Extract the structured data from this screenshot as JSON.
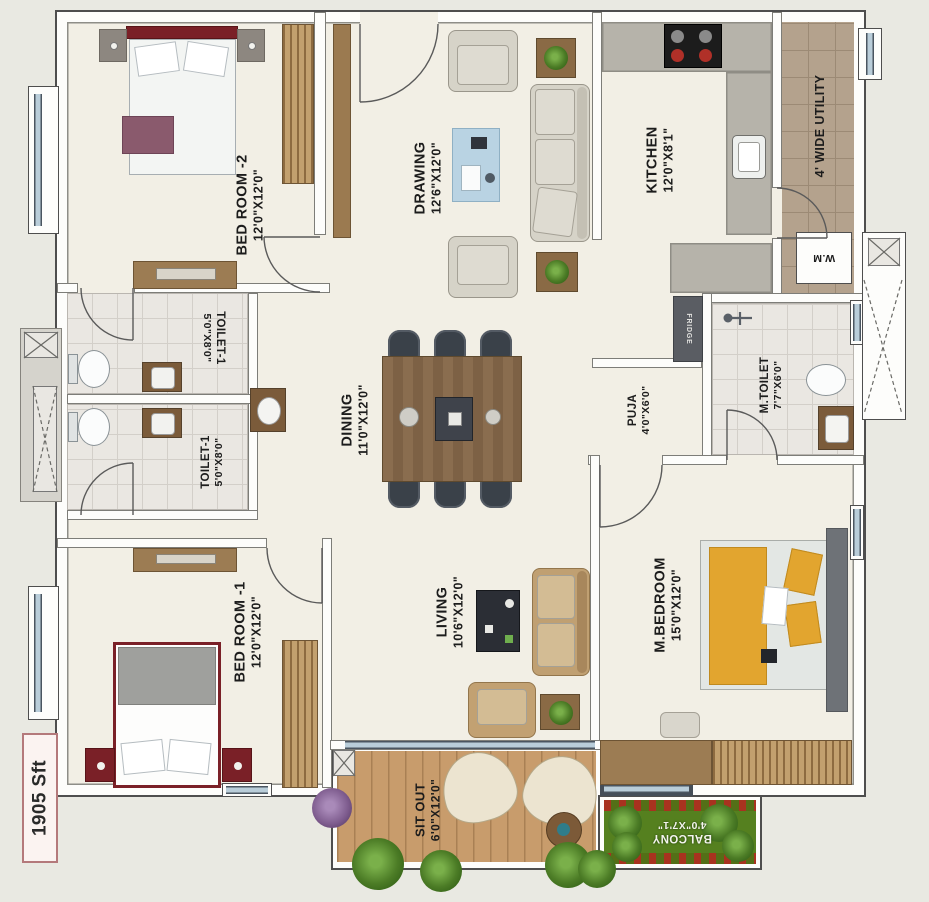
{
  "area_label": "1905 Sft",
  "rooms": {
    "bedroom2": {
      "name": "BED ROOM -2",
      "dims": "12'0\"X12'0\""
    },
    "drawing": {
      "name": "DRAWING",
      "dims": "12'6\"X12'0\""
    },
    "kitchen": {
      "name": "KITCHEN",
      "dims": "12'0\"X8'1\""
    },
    "utility": {
      "name": "4' WIDE UTILITY"
    },
    "toilet_upper": {
      "name": "TOILET-1",
      "dims": "5'0\"X8'0\""
    },
    "toilet_lower": {
      "name": "TOILET-1",
      "dims": "5'0\"X8'0\""
    },
    "dining": {
      "name": "DINING",
      "dims": "11'0\"X12'0\""
    },
    "puja": {
      "name": "PUJA",
      "dims": "4'0\"X6'0\""
    },
    "m_toilet": {
      "name": "M.TOILET",
      "dims": "7'7\"X6'0\""
    },
    "bedroom1": {
      "name": "BED ROOM -1",
      "dims": "12'0\"X12'0\""
    },
    "living": {
      "name": "LIVING",
      "dims": "10'6\"X12'0\""
    },
    "m_bedroom": {
      "name": "M.BEDROOM",
      "dims": "15'0\"X12'0\""
    },
    "sit_out": {
      "name": "SIT OUT",
      "dims": "6'0\"X12'0\""
    },
    "balcony": {
      "name": "BALCONY",
      "dims": "4'0\"X7'1\""
    }
  },
  "appliances": {
    "washing_machine": "W.M",
    "fridge": "FRIDGE"
  },
  "colors": {
    "wall": "#fdfdfb",
    "floor": "#f2efe5",
    "tile": "#eae7e2",
    "wood": "#9c7c53",
    "granite": "#b6b3aa",
    "balcony_green": "#55801f",
    "headboard_red": "#7a2027",
    "duvet_yellow": "#e2a52f",
    "background": "#e9e9e2"
  }
}
